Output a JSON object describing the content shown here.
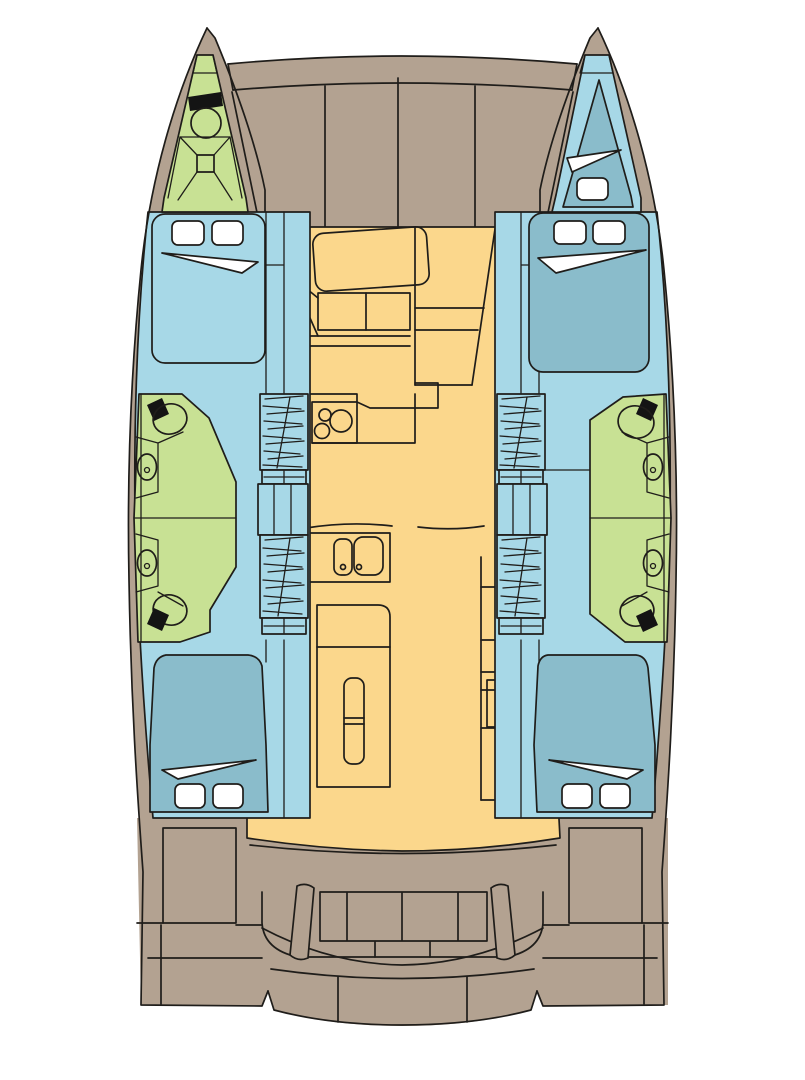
{
  "canvas": {
    "width": 805,
    "height": 1080,
    "title": "Catamaran interior deck plan"
  },
  "colors": {
    "bg": "#ffffff",
    "hull": "#b3a291",
    "cabin": "#a7d8e7",
    "bed": "#8abccb",
    "wet": "#c8e194",
    "salon": "#fbd78c",
    "white": "#ffffff",
    "black": "#141414",
    "line": "#1f1d1a"
  },
  "icons": {
    "toilet": "toilet-icon",
    "sink": "sink-icon",
    "stove": "stove-burners-icon",
    "galley_sink": "double-sink-icon",
    "stairs": "companionway-stairs-icon",
    "berth": "double-berth-icon",
    "pillow": "pillow-icon",
    "sheet": "folded-sheet-icon",
    "bench": "cockpit-bench-icon",
    "platform": "swim-platform-icon",
    "anchor_locker": "anchor-locker-icon",
    "chart_table": "salon-table-icon",
    "fridge": "fridge-icon",
    "cabinet": "cabinet-icon"
  }
}
